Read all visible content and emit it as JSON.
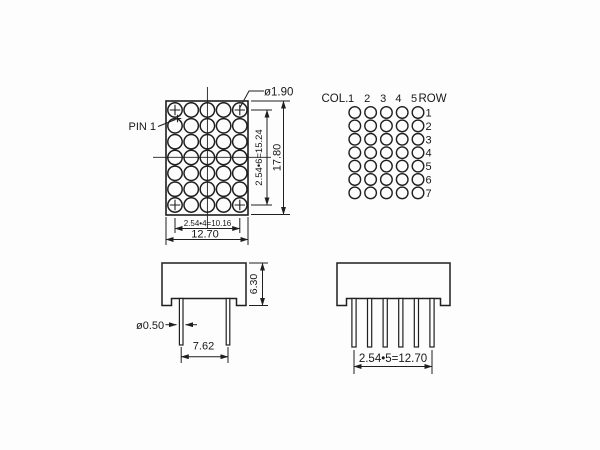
{
  "colors": {
    "background": "#fdfdfd",
    "line": "#1f1f1f"
  },
  "front_view": {
    "rows": 7,
    "columns": 5,
    "pin1_label": "PIN 1",
    "dot_diameter_label": "ø1.90",
    "vertical_pitch_label": "2.54•6=15.24",
    "overall_height_label": "17.80",
    "horizontal_pitch_label": "2.54•4=10.16",
    "overall_width_label": "12.70"
  },
  "schematic": {
    "rows": 7,
    "columns": 5,
    "col_header": "COL.",
    "row_header": "ROW",
    "column_numbers": [
      "1",
      "2",
      "3",
      "4",
      "5"
    ],
    "row_numbers": [
      "1",
      "2",
      "3",
      "4",
      "5",
      "6",
      "7"
    ]
  },
  "side_view": {
    "body_height_label": "6.30",
    "pin_diameter_label": "ø0.50",
    "pin_spacing_label": "7.62"
  },
  "bottom_view": {
    "pins": 6,
    "pin_pitch_label": "2.54•5=12.70"
  }
}
